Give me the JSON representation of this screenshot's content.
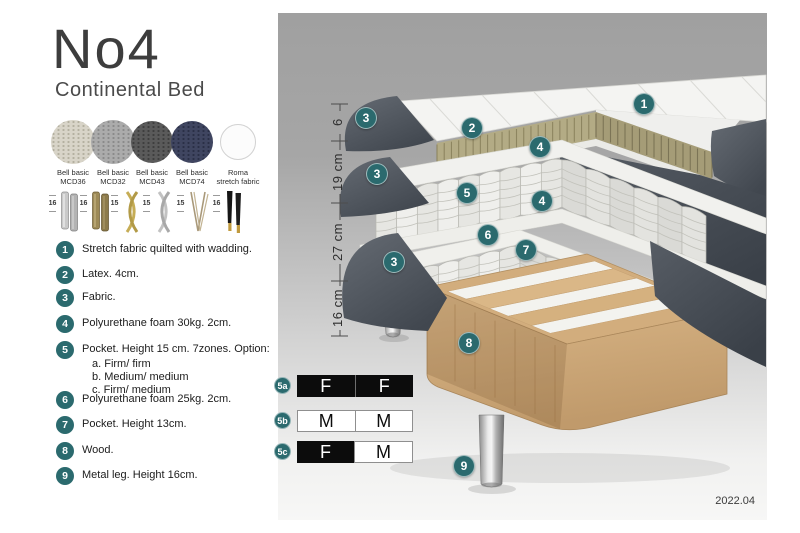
{
  "colors": {
    "accent_teal": "#2b6a6e",
    "fabric_dark_grey": "#4a5058",
    "latex_tan": "#b3ab85",
    "wood": "#d2ad7d"
  },
  "header": {
    "title": "No4",
    "subtitle": "Continental Bed"
  },
  "fabrics": [
    {
      "name": "Bell basic",
      "code": "MCD36",
      "color": "#d8d4c8",
      "dot": "#b4b0a0"
    },
    {
      "name": "Bell basic",
      "code": "MCD32",
      "color": "#ababab",
      "dot": "#8a8a8a"
    },
    {
      "name": "Bell basic",
      "code": "MCD43",
      "color": "#5a5a5a",
      "dot": "#3e3e3e"
    },
    {
      "name": "Bell basic",
      "code": "MCD74",
      "color": "#3f4560",
      "dot": "#2a2f46"
    },
    {
      "name": "Roma",
      "code": "stretch fabric",
      "color": "#fcfcfc",
      "dot": "#f0f0f0"
    }
  ],
  "legs": [
    {
      "height": "16",
      "style": "cylinder-chrome"
    },
    {
      "height": "16",
      "style": "cylinder-bronze"
    },
    {
      "height": "15",
      "style": "cross-gold"
    },
    {
      "height": "15",
      "style": "cross-silver"
    },
    {
      "height": "15",
      "style": "hairpin"
    },
    {
      "height": "16",
      "style": "taper-black-gold"
    }
  ],
  "parts": [
    {
      "num": "1",
      "text": "Stretch fabric quilted with wadding."
    },
    {
      "num": "2",
      "text": "Latex. 4cm."
    },
    {
      "num": "3",
      "text": "Fabric."
    },
    {
      "num": "4",
      "text": "Polyurethane foam 30kg. 2cm."
    },
    {
      "num": "5",
      "text": "Pocket. Height 15 cm. 7zones. Option:",
      "options": [
        "a. Firm/ firm",
        "b. Medium/ medium",
        "c. Firm/ medium"
      ]
    },
    {
      "num": "6",
      "text": "Polyurethane foam 25kg. 2cm."
    },
    {
      "num": "7",
      "text": "Pocket. Height 13cm."
    },
    {
      "num": "8",
      "text": "Wood."
    },
    {
      "num": "9",
      "text": "Metal leg. Height 16cm."
    }
  ],
  "diagram": {
    "dimensions": [
      {
        "label": "6"
      },
      {
        "label": "19 cm"
      },
      {
        "label": "27 cm"
      },
      {
        "label": "16 cm"
      }
    ],
    "callouts": [
      "1",
      "3",
      "2",
      "4",
      "3",
      "5",
      "4",
      "6",
      "7",
      "3",
      "8",
      "9"
    ],
    "firmness": [
      {
        "id": "5a",
        "cells": [
          {
            "label": "F",
            "variant": "dark"
          },
          {
            "label": "F",
            "variant": "dark"
          }
        ]
      },
      {
        "id": "5b",
        "cells": [
          {
            "label": "M",
            "variant": "light"
          },
          {
            "label": "M",
            "variant": "light"
          }
        ]
      },
      {
        "id": "5c",
        "cells": [
          {
            "label": "F",
            "variant": "dark"
          },
          {
            "label": "M",
            "variant": "light"
          }
        ]
      }
    ]
  },
  "footer": {
    "version": "2022.04"
  }
}
